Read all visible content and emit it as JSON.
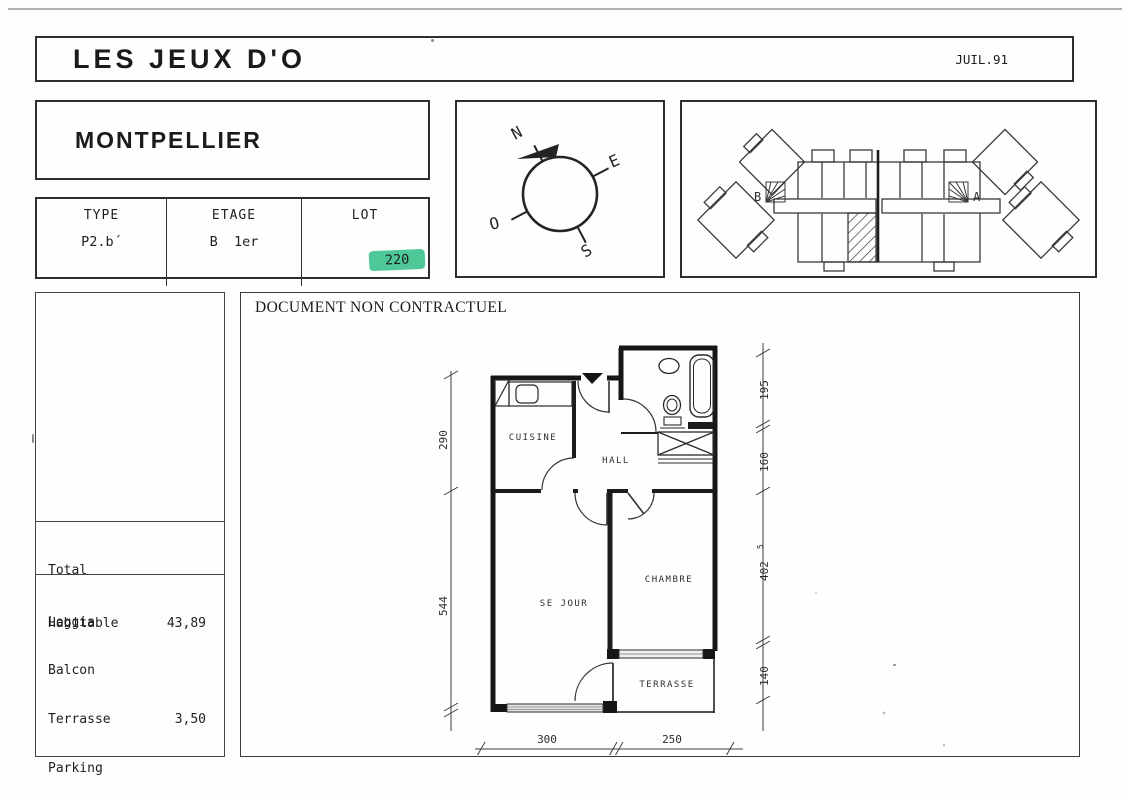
{
  "header": {
    "title": "LES JEUX D'O",
    "date": "JUIL.91"
  },
  "location": {
    "city": "MONTPELLIER"
  },
  "lot_table": {
    "type_header": "TYPE",
    "type_value": "P2.b´",
    "etage_header": "ETAGE",
    "etage_value": "B  1er",
    "lot_header": "LOT",
    "lot_value": "220"
  },
  "compass": {
    "north": "N",
    "east": "E",
    "west": "O",
    "south": "S"
  },
  "site_plan": {
    "stair_left": "B",
    "stair_right": "A"
  },
  "plan": {
    "disclaimer": "DOCUMENT NON CONTRACTUEL",
    "rooms": {
      "cuisine": "CUISINE",
      "hall": "HALL",
      "sejour": "SE JOUR",
      "chambre": "CHAMBRE",
      "terrasse": "TERRASSE"
    },
    "dims": {
      "left_top": "290",
      "left_bottom": "544",
      "right_1": "195",
      "right_2": "160",
      "right_3": "402",
      "right_3_sup": "5",
      "right_4": "140",
      "bottom_left": "300",
      "bottom_right": "250"
    }
  },
  "areas": {
    "total_line1": "Total",
    "total_label": "Habitable",
    "total_value": "43,89",
    "annex_1": "Loggia",
    "annex_2": "Balcon",
    "annex_3": "Terrasse",
    "annex_value": "3,50",
    "annex_4": "Parking"
  },
  "colors": {
    "highlight": "#4ec897"
  }
}
